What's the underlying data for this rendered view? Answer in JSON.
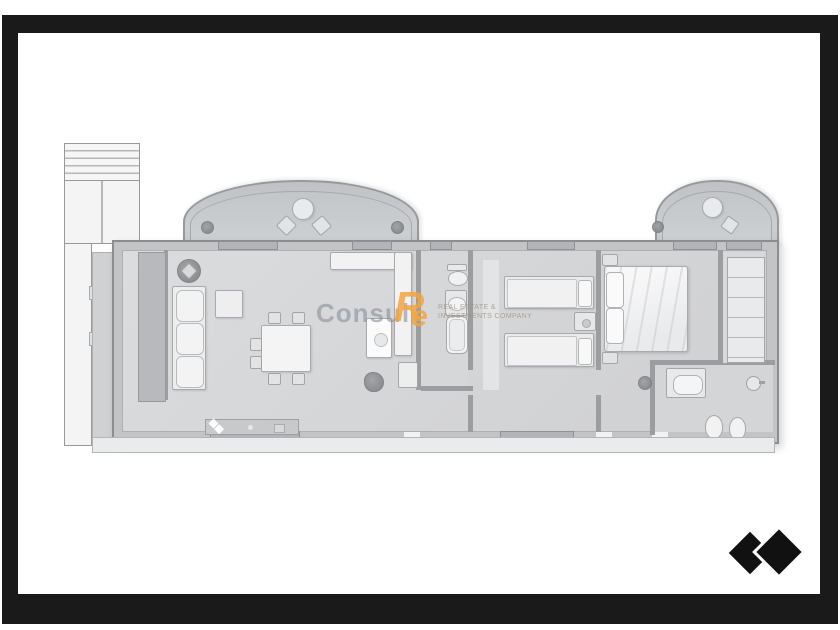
{
  "page": {
    "background_color": "#ffffff",
    "frame_color": "#1a1a1a"
  },
  "watermark": {
    "brand": "Consul",
    "monogram_r": "R",
    "monogram_e": "e",
    "tagline_line1": "REAL ESTATE &",
    "tagline_line2": "INVESTMENTS COMPANY",
    "brand_color": "#8c96a0",
    "monogram_color": "#f2a63c"
  },
  "logo": {
    "icon": "two-black-diamonds-icon",
    "color": "#111111"
  },
  "plan": {
    "wall_color": "#c2c4c6",
    "floor_color": "#d7d8da",
    "furniture_color": "#f1f1f2",
    "bay_color": "#c7cacc"
  }
}
